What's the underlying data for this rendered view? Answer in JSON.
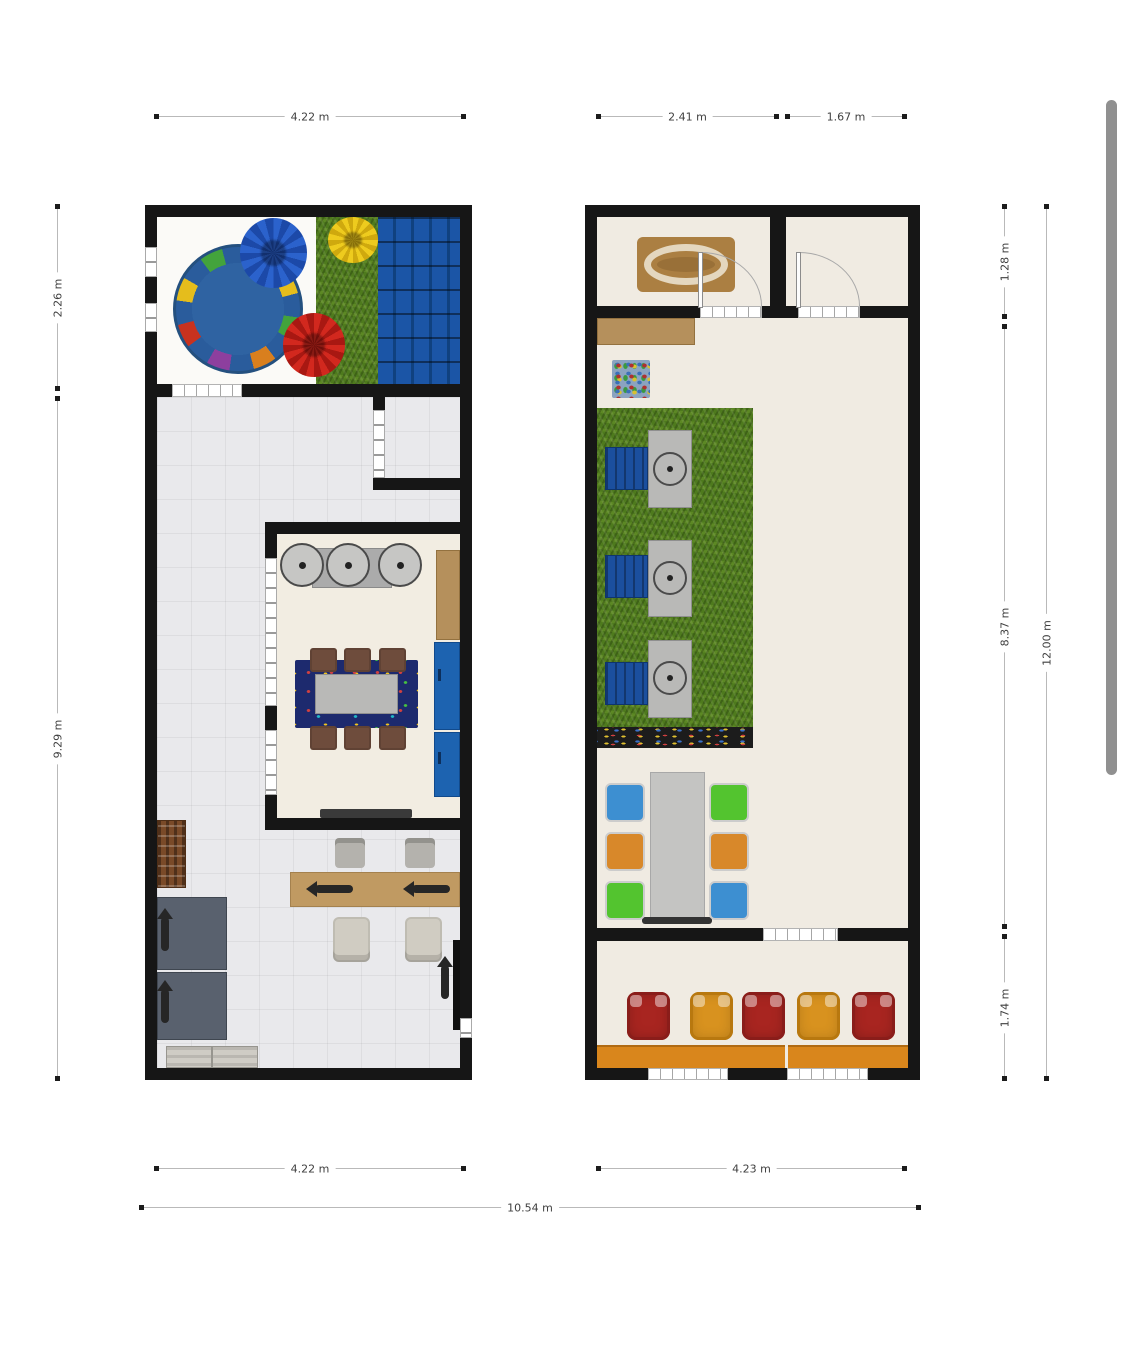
{
  "page": {
    "background": "#ffffff",
    "content": "floor-plan-viewer"
  },
  "scrollbar": {
    "visible": true,
    "thumb_color": "#909090"
  },
  "dimensions": {
    "plan1_top_width": "4.22 m",
    "plan2_top_left_width": "2.41 m",
    "plan2_top_right_width": "1.67 m",
    "plan1_side_play_height": "2.26 m",
    "plan1_side_main_height": "9.29 m",
    "plan2_side_top_height": "1.28 m",
    "plan2_side_middle_height": "8.37 m",
    "plan2_side_bottom_height": "1.74 m",
    "plan2_side_total_height": "12.00 m",
    "plan1_bottom_width": "4.22 m",
    "plan2_bottom_width": "4.23 m",
    "overall_bottom_width": "10.54 m"
  },
  "palette": {
    "wall": "#161616",
    "tile_floor": "#e9e9ec",
    "cream_floor": "#f0ebe2",
    "grass": "#4e7a1d",
    "nap_mat_blue": "#1b55a6",
    "rug_blue": "#2f63a2",
    "bean_blue": "#2b62cc",
    "bean_yellow": "#eecb1e",
    "bean_red": "#d2281e",
    "chair_brown": "#6e4c3c",
    "cabinet_blue": "#1d63b0",
    "counter_tan": "#b5905c",
    "desk_wood": "#c09a62",
    "kid_chair_blue": "#3d8fd1",
    "kid_chair_orange": "#d8882a",
    "kid_chair_green": "#53c42f",
    "armchair_red": "#a82520",
    "armchair_orange": "#d8921f",
    "counter_orange": "#d9861c"
  },
  "plan1": {
    "name": "left-floor-plan",
    "areas": [
      "play-area",
      "main-room",
      "small-room",
      "kitchen-room",
      "office-area"
    ],
    "furniture": [
      "circle-rug",
      "bean-bag-blue",
      "bean-bag-yellow",
      "bean-bag-red",
      "grass-rug",
      "nap-mats",
      "stool-counter",
      "dining-table",
      "dining-chairs",
      "table-rug",
      "tan-counter",
      "blue-cabinets",
      "kitchen-bench",
      "office-desk",
      "office-chairs",
      "bookshelf",
      "gray-tables",
      "bench",
      "wall-tv"
    ]
  },
  "plan2": {
    "name": "right-floor-plan",
    "areas": [
      "top-room-left",
      "top-room-right",
      "main-room",
      "bottom-room"
    ],
    "furniture": [
      "oval-rug",
      "entry-door-left",
      "entry-door-right",
      "side-counter",
      "play-mat-rug",
      "grass-rug",
      "activity-stations",
      "nap-mats",
      "toy-shelf",
      "kids-table",
      "kid-chairs",
      "armchairs",
      "window-bench-counters"
    ]
  }
}
